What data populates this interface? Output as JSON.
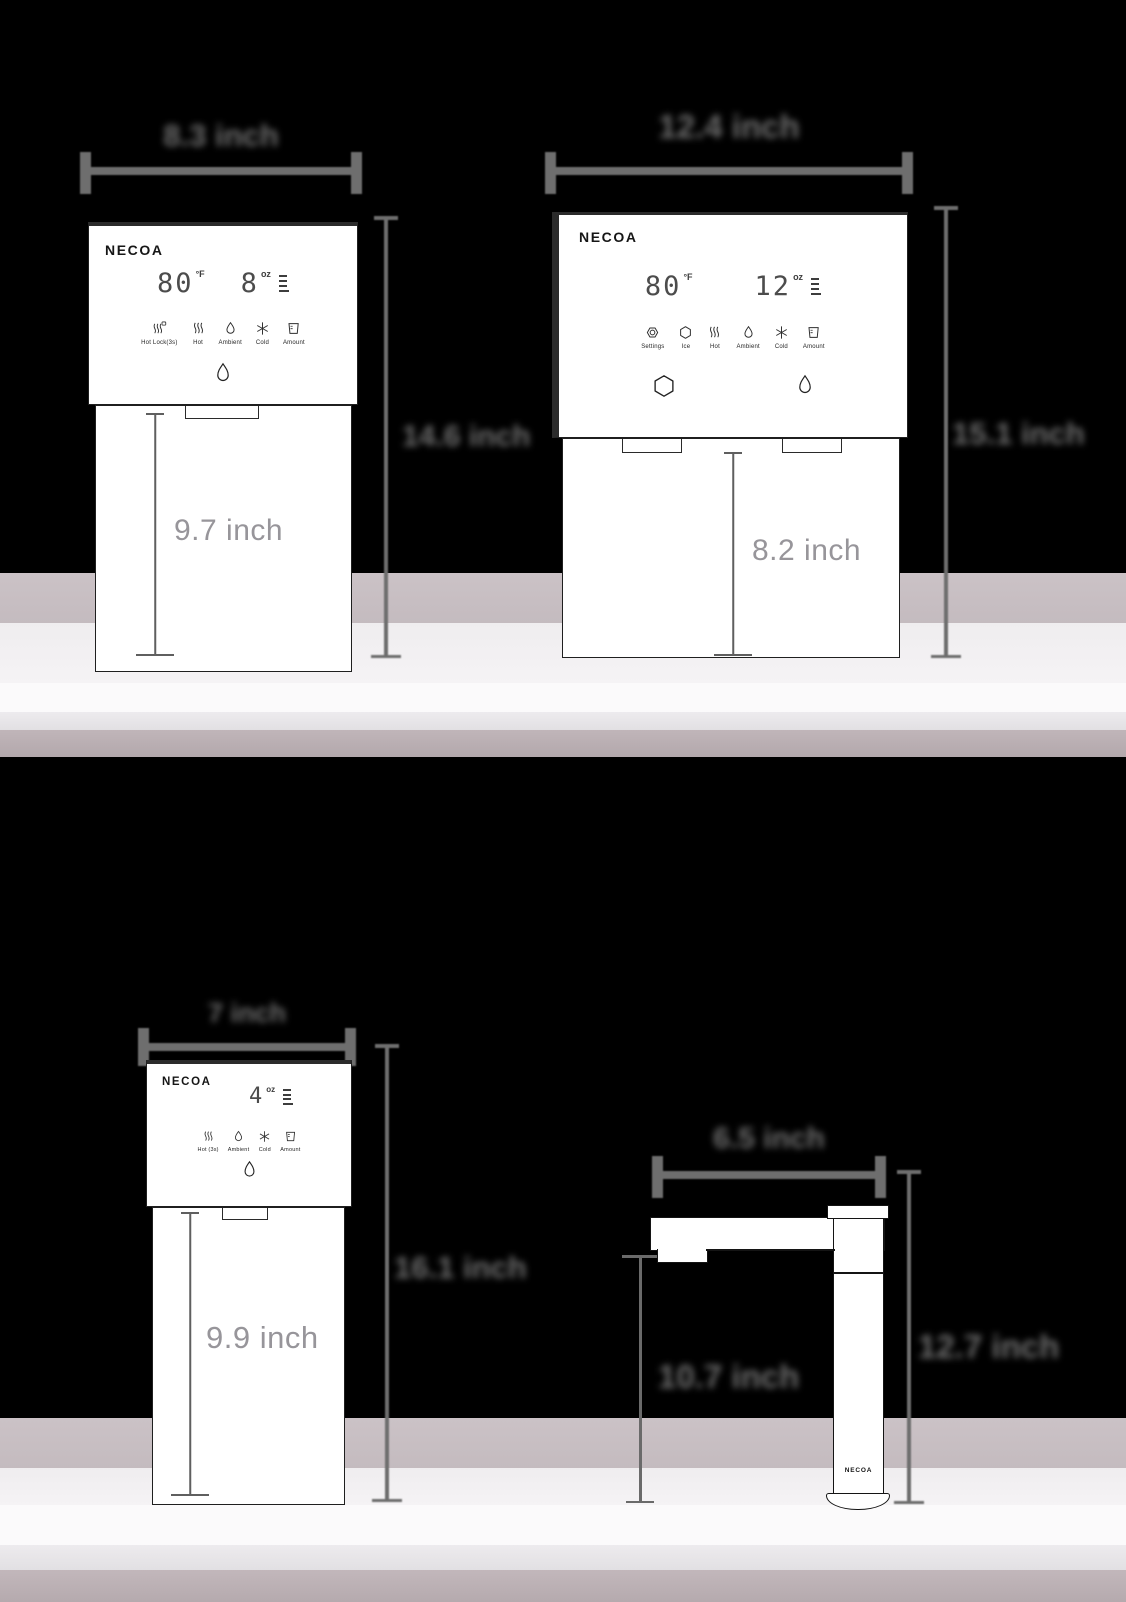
{
  "brand": "NECOA",
  "dispenser_a": {
    "width_label": "8.3 inch",
    "height_label": "14.6 inch",
    "body_height_label": "9.7 inch",
    "display": {
      "temp": "80",
      "temp_unit": "°F",
      "amount": "8",
      "amount_unit": "oz"
    },
    "controls": [
      {
        "label": "Hot Lock(3s)"
      },
      {
        "label": "Hot"
      },
      {
        "label": "Ambient"
      },
      {
        "label": "Cold"
      },
      {
        "label": "Amount"
      }
    ]
  },
  "dispenser_b": {
    "width_label": "12.4 inch",
    "height_label": "15.1 inch",
    "body_height_label": "8.2 inch",
    "display": {
      "temp": "80",
      "temp_unit": "°F",
      "amount": "12",
      "amount_unit": "oz"
    },
    "controls": [
      {
        "label": "Settings"
      },
      {
        "label": "Ice"
      },
      {
        "label": "Hot"
      },
      {
        "label": "Ambient"
      },
      {
        "label": "Cold"
      },
      {
        "label": "Amount"
      }
    ]
  },
  "dispenser_c": {
    "width_label": "7 inch",
    "height_label": "16.1 inch",
    "body_height_label": "9.9 inch",
    "display": {
      "amount": "4",
      "amount_unit": "oz"
    },
    "controls": [
      {
        "label": "Hot (3s)"
      },
      {
        "label": "Ambient"
      },
      {
        "label": "Cold"
      },
      {
        "label": "Amount"
      }
    ]
  },
  "faucet": {
    "width_label": "6.5 inch",
    "spout_height_label": "10.7 inch",
    "height_label": "12.7 inch"
  },
  "colors": {
    "background": "#000000",
    "counter_mauve": "#c8bfc3",
    "counter_light": "#f3f1f3",
    "counter_white": "#fbfafb",
    "counter_shade": "#e7e5e8",
    "counter_edge": "#b7acb0",
    "dimension_gray": "#6e6e6e",
    "inner_label_gray": "#97959a",
    "panel_ink": "#2f2f2f"
  }
}
